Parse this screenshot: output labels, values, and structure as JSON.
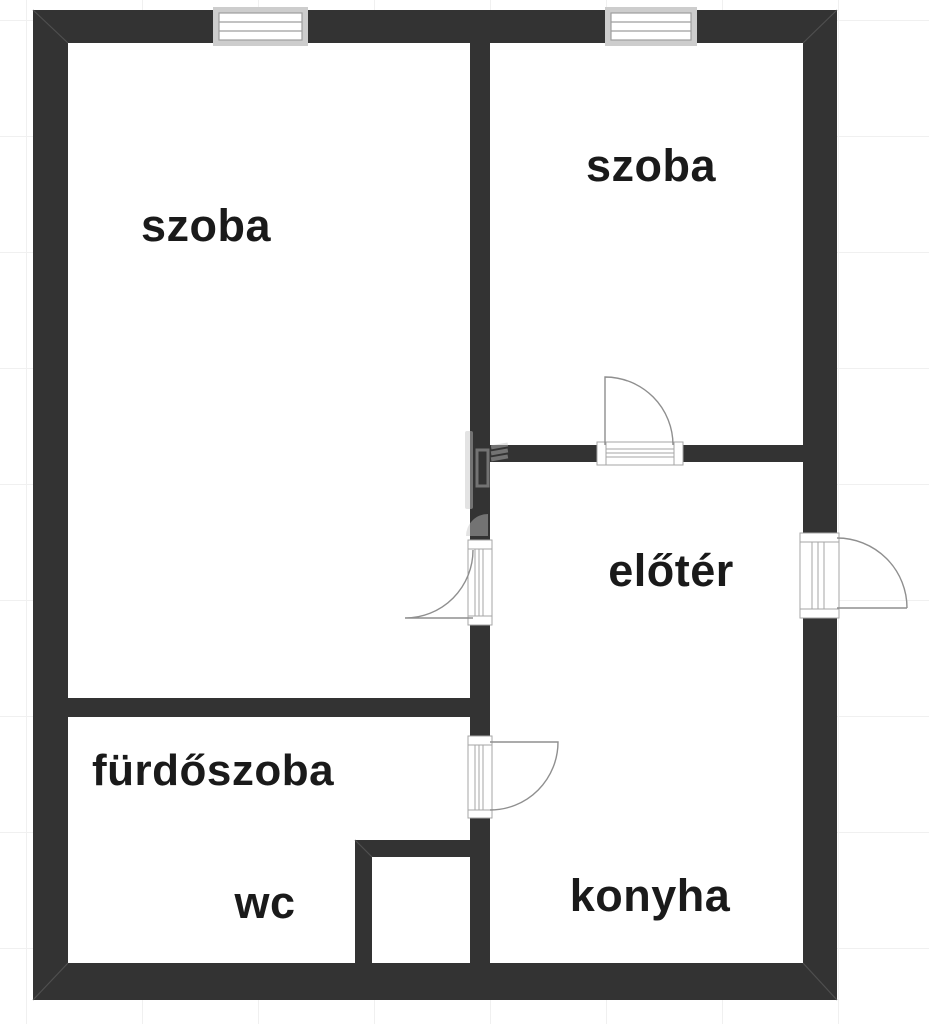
{
  "plan": {
    "title": "apartment floor plan",
    "wall_color": "#333333",
    "label_color": "#1a1a1a",
    "grid_color": "#f0f0f0",
    "rooms": [
      {
        "id": "szoba-left",
        "label": "szoba"
      },
      {
        "id": "szoba-right",
        "label": "szoba"
      },
      {
        "id": "eloter",
        "label": "előtér"
      },
      {
        "id": "furdoszoba",
        "label": "fürdőszoba"
      },
      {
        "id": "wc",
        "label": "wc"
      },
      {
        "id": "konyha",
        "label": "konyha"
      }
    ],
    "windows": [
      {
        "id": "window-szoba-left-top",
        "wall": "top"
      },
      {
        "id": "window-szoba-right-top",
        "wall": "top"
      }
    ],
    "doors": [
      {
        "id": "door-szoba-right-to-eloter",
        "swing": "into szoba-right"
      },
      {
        "id": "door-szoba-left-to-eloter",
        "swing": "into szoba-left"
      },
      {
        "id": "door-entrance-right-wall",
        "swing": "outward right"
      },
      {
        "id": "door-furdoszoba-to-konyha",
        "swing": "into konyha"
      }
    ]
  }
}
